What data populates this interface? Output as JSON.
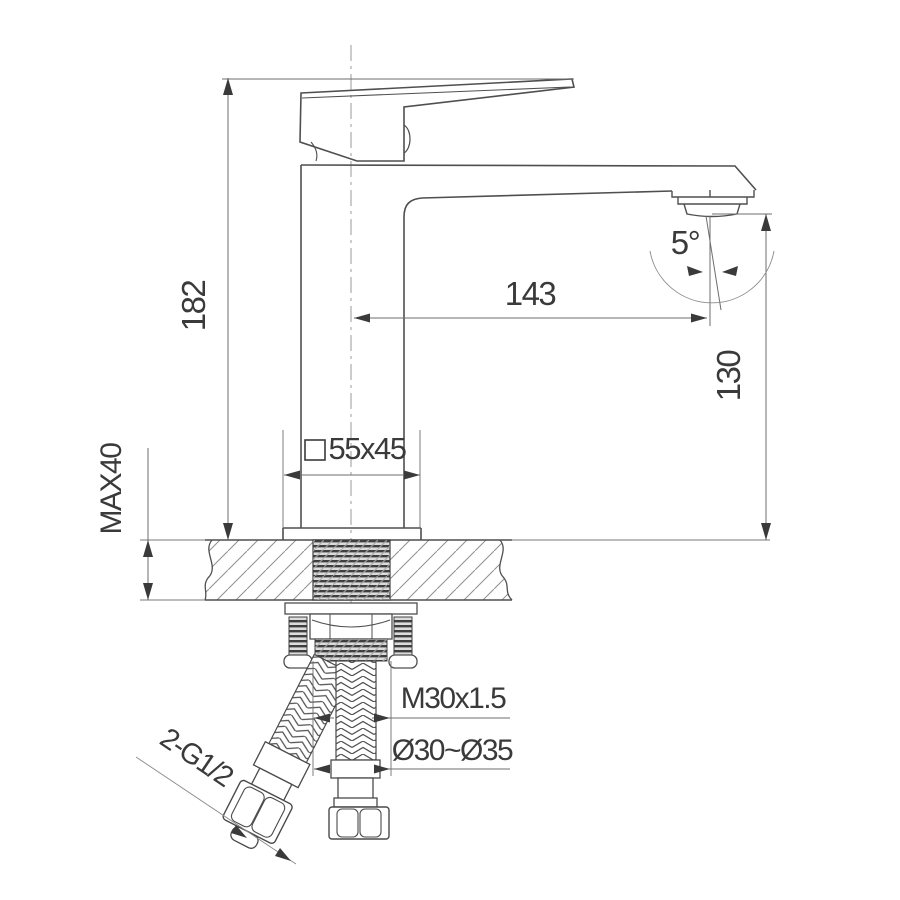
{
  "diagram": {
    "type": "technical-drawing",
    "subject": "Single-lever basin faucet — side elevation with installation cross-section",
    "labels": {
      "overall_height": "182",
      "deck_max_thickness": "MAX40",
      "spout_reach": "143",
      "stream_angle": "5°",
      "outlet_height": "130",
      "base_section": "55x45",
      "shank_thread": "M30x1.5",
      "hole_diameter": "Ø30~Ø35",
      "hose_connections": "2-G1/2"
    },
    "colors": {
      "object_line": "#4f4f4f",
      "dimension_line": "#6e6e6e",
      "text": "#3a3a3a",
      "background": "#ffffff"
    }
  }
}
